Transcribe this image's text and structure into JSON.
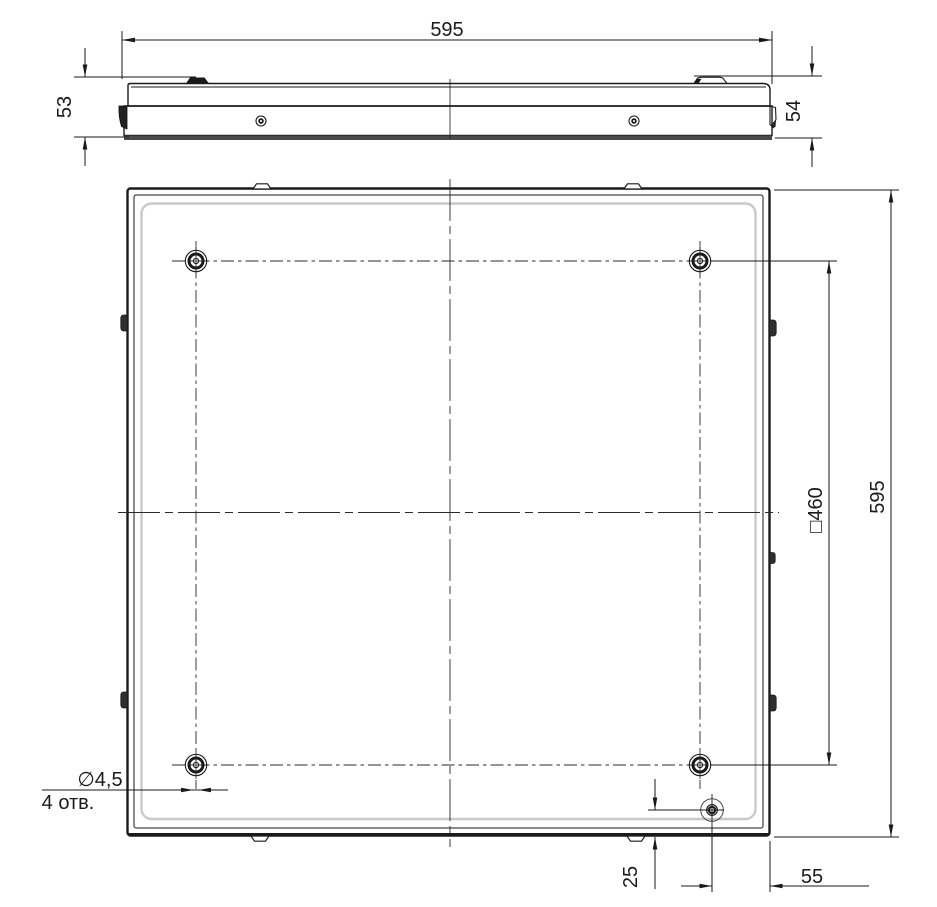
{
  "colors": {
    "line": "#1a1a1a",
    "frame_inner": "#c9c9c9",
    "base_band": "#4a4a4a"
  },
  "side_view": {
    "width": "595",
    "height_left": "53",
    "height_right": "54"
  },
  "back_view": {
    "height": "595",
    "mounting_square": "□460",
    "hole_diameter": "∅4,5",
    "hole_count": "4 отв.",
    "inlet_offset_bottom": "25",
    "inlet_offset_right": "55"
  }
}
